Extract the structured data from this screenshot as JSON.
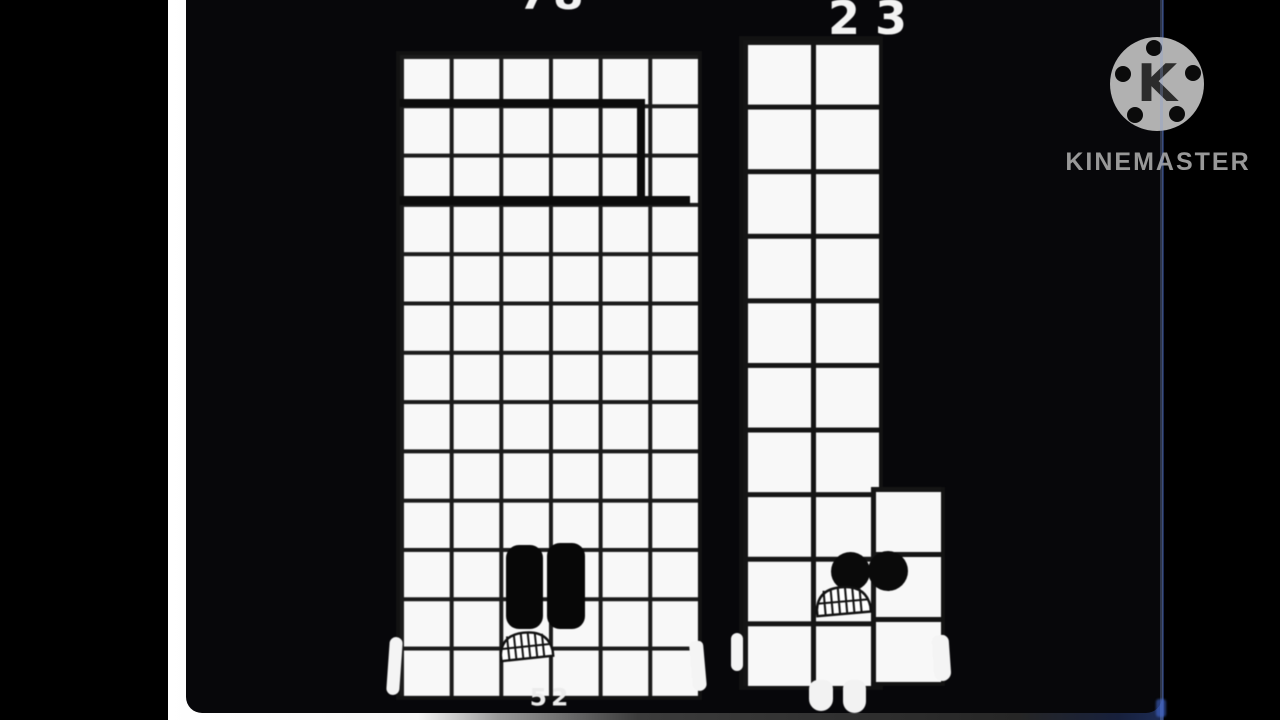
{
  "video": {
    "watermark": {
      "logo_letter": "K",
      "brand": "KINEMASTER"
    }
  },
  "characters": [
    {
      "id": "numberblock-78",
      "top_label": "78",
      "bottom_label": "52",
      "grid": {
        "cols": 6,
        "rows": 13
      },
      "total_blocks": 78,
      "marker": "thick outline around a 5x2 ten-block at rows 2-3"
    },
    {
      "id": "numberblock-23",
      "top_label": "23",
      "grid": {
        "cols": 2,
        "rows": 10
      },
      "extension_grid": {
        "cols": 1,
        "rows": 3
      },
      "total_blocks": 23
    }
  ],
  "colors": {
    "background": "#000000",
    "video_background": "#07070a",
    "block_fill": "#f8f8f8",
    "grid_line": "#1b1b1b",
    "label_text": "#f2f2f2",
    "backing_white": "#ffffff",
    "watermark_gray": "#b1b1b1",
    "edge_line_blue": "#87a0d7"
  }
}
